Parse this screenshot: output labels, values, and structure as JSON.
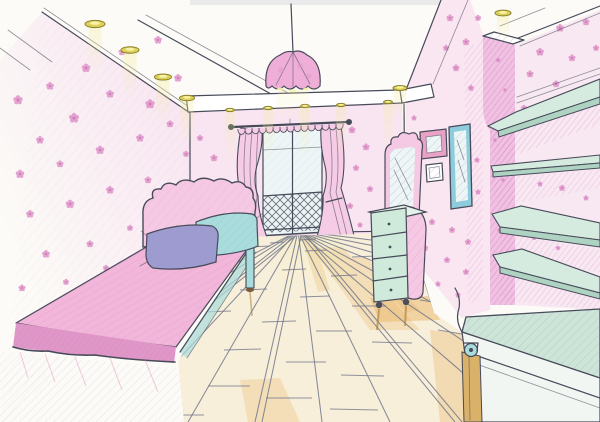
{
  "scene": {
    "title": "Hand-drawn one-point perspective sketch of a pink girls' bedroom interior",
    "medium": "colored pencil sketch"
  },
  "palette": {
    "paper": "#fcfbf7",
    "line": "#474a59",
    "wall_pink": "#f7e0f0",
    "wall_pink_deep": "#f0c2e2",
    "floral_pink": "#dd8fc7",
    "floral_core": "#c862ab",
    "hatch_pink": "#d878bd",
    "bed_pink": "#f1b6da",
    "bed_pink_deep": "#df97c8",
    "headboard_pink": "#f5c9e4",
    "pillow_purple": "#9e9bd1",
    "pillow_teal": "#a9dcdc",
    "curtain_pink": "#f5cbe6",
    "lamp_pink": "#eeaed8",
    "spot_gold": "#ddd158",
    "spot_rim": "#8a7f2e",
    "beam_yellow": "#f3eca0",
    "shelf_teal": "#d6ebdf",
    "shelf_edge": "#afd3c2",
    "dresser_mint": "#cfe9da",
    "frame_blue": "#8cccdd",
    "frame_pink": "#e9a2c6",
    "glass_blue": "#edf5f6",
    "floor_cream": "#f8efdb",
    "floor_orange": "#e9b568",
    "floor_line": "#74788a",
    "bench_teal": "#cde4d8",
    "wood_tan": "#d9b169",
    "white": "#ffffff"
  },
  "objects": {
    "ceiling": {
      "label": "tray ceiling with recessed spotlights",
      "left_soffit_spotlights": 4,
      "fascia_spotlights": 5,
      "right_spotlights": 2
    },
    "pendant_lamp": {
      "label": "pink dome pendant lamp"
    },
    "window": {
      "label": "balcony window with two tied-back pink curtains and lattice railing"
    },
    "bed": {
      "label": "single bed with scalloped pink headboard",
      "pillow_colors": [
        "purple",
        "teal"
      ]
    },
    "dresser": {
      "label": "mint chest of drawers with vanity mirror",
      "drawers": 4
    },
    "wall_frames": [
      {
        "label": "pink picture frame"
      },
      {
        "label": "small picture frame"
      },
      {
        "label": "tall blue framed mirror"
      }
    ],
    "shelves": {
      "label": "teal wall shelves on right wall",
      "count": 4
    },
    "bench": {
      "label": "low rolling bench cabinet with caster wheel"
    },
    "floor": {
      "label": "wooden plank floor in perspective"
    },
    "wallpaper": {
      "label": "pink floral wallpaper"
    }
  },
  "wallpaper": {
    "flowers": {
      "left": [
        [
          18,
          100,
          1.2
        ],
        [
          50,
          86,
          1.0
        ],
        [
          86,
          68,
          1.1
        ],
        [
          122,
          52,
          0.9
        ],
        [
          158,
          40,
          1.0
        ],
        [
          178,
          78,
          1.0
        ],
        [
          150,
          104,
          1.2
        ],
        [
          110,
          94,
          1.0
        ],
        [
          74,
          118,
          1.3
        ],
        [
          40,
          140,
          1.0
        ],
        [
          20,
          174,
          1.1
        ],
        [
          60,
          164,
          0.9
        ],
        [
          100,
          150,
          1.1
        ],
        [
          140,
          138,
          1.0
        ],
        [
          170,
          124,
          0.9
        ],
        [
          186,
          154,
          0.8
        ],
        [
          30,
          214,
          1.0
        ],
        [
          70,
          204,
          1.1
        ],
        [
          110,
          190,
          1.0
        ],
        [
          148,
          180,
          0.9
        ],
        [
          46,
          254,
          1.0
        ],
        [
          90,
          244,
          0.9
        ],
        [
          130,
          228,
          0.8
        ],
        [
          22,
          288,
          0.9
        ],
        [
          66,
          282,
          0.8
        ],
        [
          106,
          268,
          0.8
        ],
        [
          176,
          198,
          0.8
        ],
        [
          186,
          228,
          0.7
        ]
      ],
      "back": [
        [
          200,
          138,
          0.8
        ],
        [
          214,
          158,
          0.9
        ],
        [
          204,
          182,
          0.8
        ],
        [
          222,
          202,
          0.8
        ],
        [
          198,
          220,
          0.7
        ],
        [
          352,
          130,
          0.9
        ],
        [
          366,
          147,
          0.9
        ],
        [
          356,
          168,
          0.8
        ],
        [
          370,
          189,
          0.8
        ],
        [
          350,
          206,
          0.8
        ],
        [
          374,
          214,
          0.7
        ],
        [
          360,
          225,
          0.7
        ]
      ],
      "right": [
        [
          450,
          18,
          0.9
        ],
        [
          466,
          42,
          0.9
        ],
        [
          478,
          18,
          0.8
        ],
        [
          456,
          68,
          0.9
        ],
        [
          471,
          88,
          0.8
        ],
        [
          446,
          48,
          0.8
        ],
        [
          420,
          96,
          0.7
        ],
        [
          414,
          118,
          0.7
        ],
        [
          416,
          212,
          0.8
        ],
        [
          432,
          222,
          0.8
        ],
        [
          452,
          230,
          0.8
        ],
        [
          468,
          242,
          0.8
        ],
        [
          425,
          248,
          0.8
        ],
        [
          447,
          260,
          0.8
        ],
        [
          466,
          272,
          0.8
        ],
        [
          438,
          284,
          0.7
        ],
        [
          458,
          295,
          0.7
        ],
        [
          477,
          160,
          0.7
        ],
        [
          478,
          192,
          0.7
        ]
      ],
      "far_right": [
        [
          560,
          28,
          1.0
        ],
        [
          586,
          22,
          0.9
        ],
        [
          540,
          52,
          1.0
        ],
        [
          572,
          58,
          0.9
        ],
        [
          596,
          48,
          0.8
        ],
        [
          530,
          74,
          0.9
        ],
        [
          556,
          84,
          0.9
        ],
        [
          589,
          88,
          0.8
        ],
        [
          524,
          108,
          0.8
        ],
        [
          548,
          106,
          0.7
        ],
        [
          562,
          188,
          0.8
        ],
        [
          586,
          198,
          0.7
        ],
        [
          540,
          184,
          0.7
        ],
        [
          534,
          238,
          0.6
        ],
        [
          558,
          248,
          0.6
        ]
      ],
      "column": [
        [
          498,
          60,
          0.6
        ],
        [
          505,
          90,
          0.5
        ],
        [
          495,
          140,
          0.5
        ],
        [
          503,
          180,
          0.5
        ],
        [
          499,
          230,
          0.5
        ]
      ]
    }
  },
  "lighting": {
    "left": {
      "beam": {
        "len": 46,
        "w": 13,
        "op": 0.5
      },
      "spots": [
        [
          95,
          24,
          10
        ],
        [
          130,
          50,
          9
        ],
        [
          163,
          77,
          8.5
        ],
        [
          187,
          98,
          7.5
        ]
      ]
    },
    "fascia": {
      "beam": {
        "len": 52,
        "w": 10,
        "op": 0.4
      },
      "spots": [
        [
          230,
          110,
          4.5
        ],
        [
          268,
          108,
          4.5
        ],
        [
          305,
          106,
          4.5
        ],
        [
          341,
          105,
          4.5
        ],
        [
          388,
          102,
          4.5
        ]
      ]
    },
    "right": {
      "beam": {
        "len": 28,
        "w": 12,
        "op": 0.5
      },
      "spots": [
        [
          400,
          88,
          7
        ],
        [
          503,
          13,
          8
        ]
      ]
    }
  },
  "floor": {
    "vp": [
      298,
      231
    ],
    "plank_lines": [
      [
        -70,
        422
      ],
      [
        -10,
        422
      ],
      [
        55,
        422
      ],
      [
        120,
        422
      ],
      [
        188,
        422
      ],
      [
        255,
        422
      ],
      [
        322,
        422
      ],
      [
        390,
        422
      ],
      [
        455,
        422
      ],
      [
        520,
        422
      ],
      [
        585,
        422
      ],
      [
        600,
        392
      ],
      [
        600,
        352
      ],
      [
        600,
        318
      ],
      [
        600,
        290
      ],
      [
        600,
        268
      ]
    ],
    "doubles": [
      2,
      5,
      8
    ],
    "seams": [
      [
        250,
        247,
        270,
        246
      ],
      [
        305,
        251,
        327,
        250
      ],
      [
        352,
        257,
        376,
        256
      ],
      [
        214,
        262,
        236,
        261
      ],
      [
        282,
        270,
        306,
        269
      ],
      [
        331,
        276,
        357,
        275
      ],
      [
        382,
        283,
        410,
        283
      ],
      [
        240,
        290,
        267,
        289
      ],
      [
        300,
        297,
        330,
        296
      ],
      [
        352,
        306,
        386,
        306
      ],
      [
        200,
        312,
        231,
        311
      ],
      [
        262,
        322,
        296,
        321
      ],
      [
        316,
        331,
        352,
        331
      ],
      [
        372,
        342,
        412,
        343
      ],
      [
        224,
        350,
        261,
        349
      ],
      [
        286,
        362,
        326,
        362
      ],
      [
        341,
        375,
        384,
        376
      ],
      [
        208,
        386,
        250,
        386
      ],
      [
        266,
        398,
        312,
        398
      ],
      [
        330,
        409,
        378,
        410
      ],
      [
        158,
        415,
        204,
        415
      ],
      [
        438,
        330,
        462,
        334
      ],
      [
        420,
        300,
        445,
        304
      ],
      [
        300,
        240,
        316,
        239
      ],
      [
        270,
        243,
        284,
        242
      ],
      [
        225,
        244,
        240,
        243
      ]
    ]
  }
}
